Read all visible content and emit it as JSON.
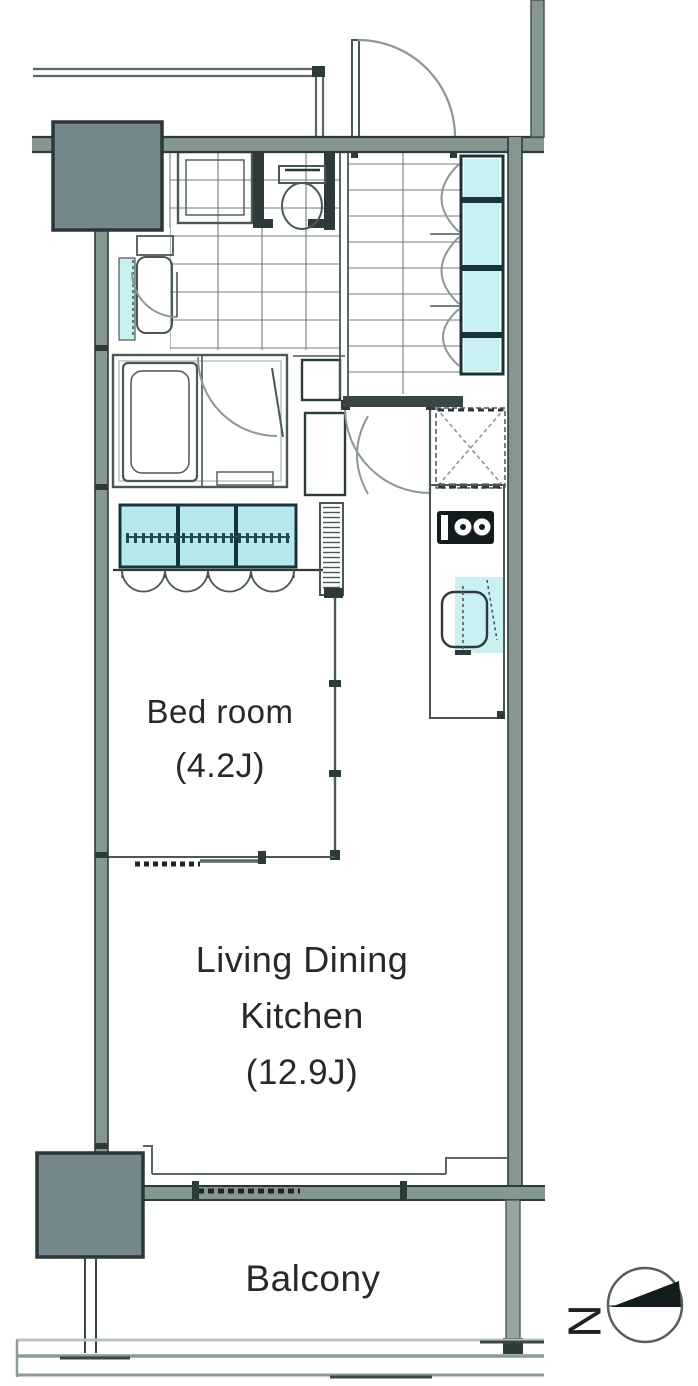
{
  "rooms": {
    "bedroom": {
      "label": "Bed room",
      "size": "(4.2J)"
    },
    "ldk": {
      "label": "Living Dining Kitchen",
      "size": "(12.9J)"
    },
    "balcony": {
      "label": "Balcony"
    }
  },
  "compass": {
    "north_label": "N"
  },
  "colors": {
    "wall": "#869690",
    "column": "#74878d",
    "fixture_cyan": "#c9f0f2",
    "closet_cyan": "#b7e9ec",
    "line_dark": "#2c3a3a"
  }
}
